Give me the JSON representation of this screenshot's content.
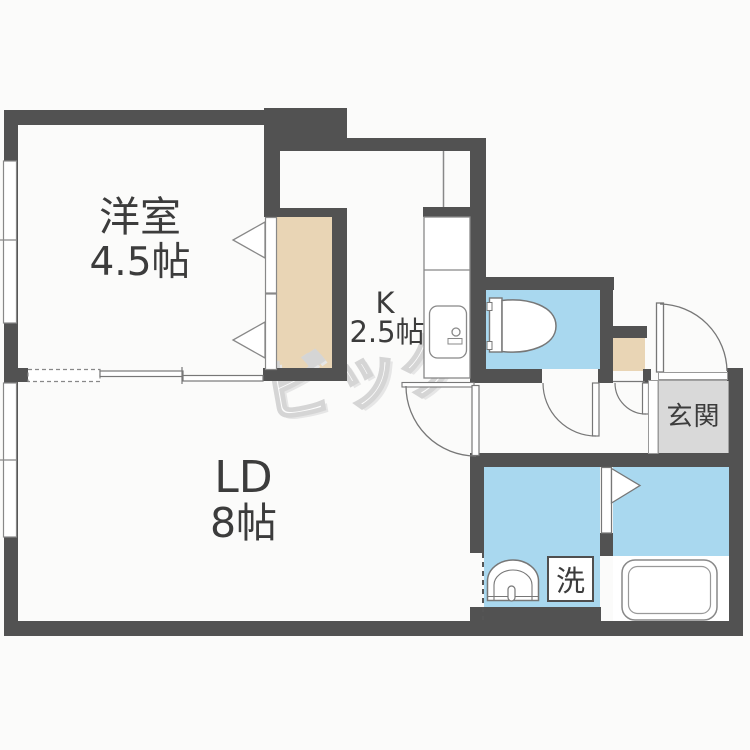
{
  "title": "1LDK apartment floor plan",
  "rooms": {
    "western": {
      "label": "洋室",
      "size": "4.5帖"
    },
    "kitchen": {
      "label": "K",
      "size": "2.5帖"
    },
    "living_dining": {
      "label": "LD",
      "size": "8帖"
    },
    "entrance": {
      "label": "玄関"
    },
    "laundry": {
      "label": "洗"
    }
  },
  "watermark": {
    "text": "ビッグ"
  },
  "colors": {
    "wall": "#525252",
    "water_area_blue": "#a9d8ef",
    "closet_beige": "#e9d5b5",
    "entrance_floor_gray": "#d9d9d9",
    "thin_line": "#7d7d7d",
    "text": "#3c3c3c",
    "watermark_gray": "#d5d5d5",
    "background": "#fbfbfa"
  },
  "fixtures": [
    "toilet",
    "bathtub",
    "washbasin",
    "kitchen-sink",
    "washing-machine-space",
    "closet",
    "shoe-storage"
  ]
}
